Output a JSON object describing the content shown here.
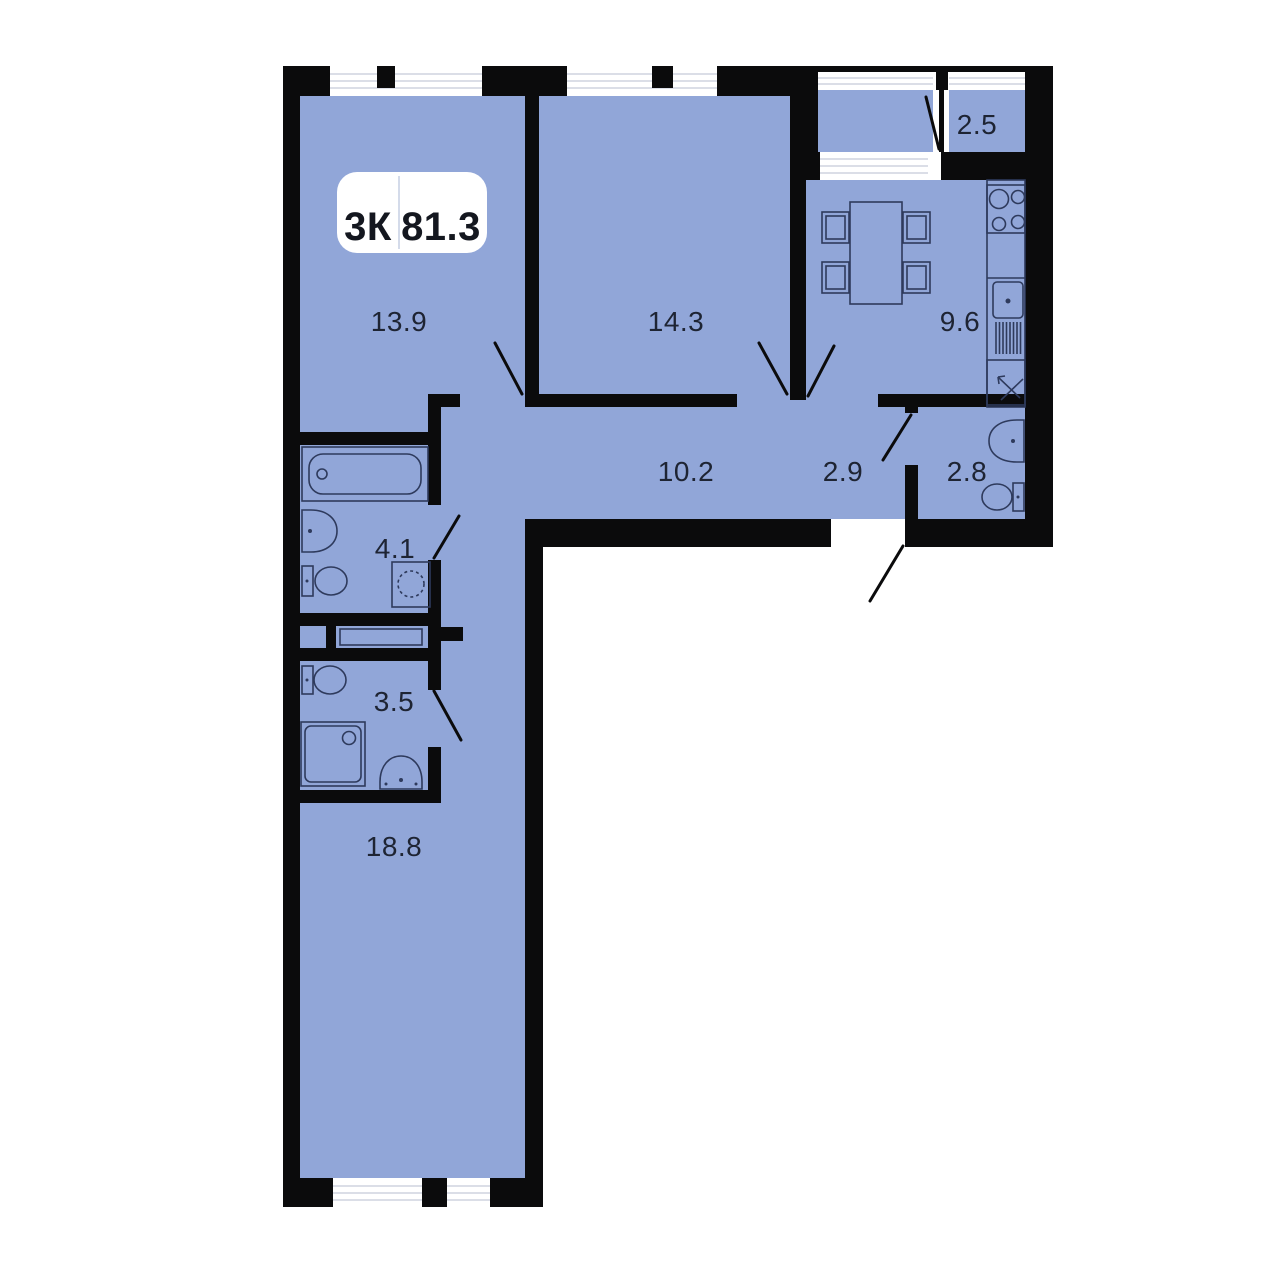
{
  "badge": {
    "rooms_label": "3К",
    "area_label": "81.3"
  },
  "rooms": [
    {
      "id": "living-room",
      "area": "13.9"
    },
    {
      "id": "bedroom",
      "area": "14.3"
    },
    {
      "id": "kitchen",
      "area": "9.6"
    },
    {
      "id": "balcony",
      "area": "2.5"
    },
    {
      "id": "corridor",
      "area": "10.2"
    },
    {
      "id": "entry-hall",
      "area": "2.9"
    },
    {
      "id": "guest-bathroom",
      "area": "2.8"
    },
    {
      "id": "bathroom",
      "area": "4.1"
    },
    {
      "id": "shower-wc",
      "area": "3.5"
    },
    {
      "id": "master-room",
      "area": "18.8"
    }
  ],
  "colors": {
    "floor": "#91a6d8",
    "wall": "#0b0b0c",
    "label": "#1e2433",
    "fixture_stroke": "#2e3a5c",
    "window_line": "#cfd4df",
    "badge_background": "#ffffff"
  }
}
